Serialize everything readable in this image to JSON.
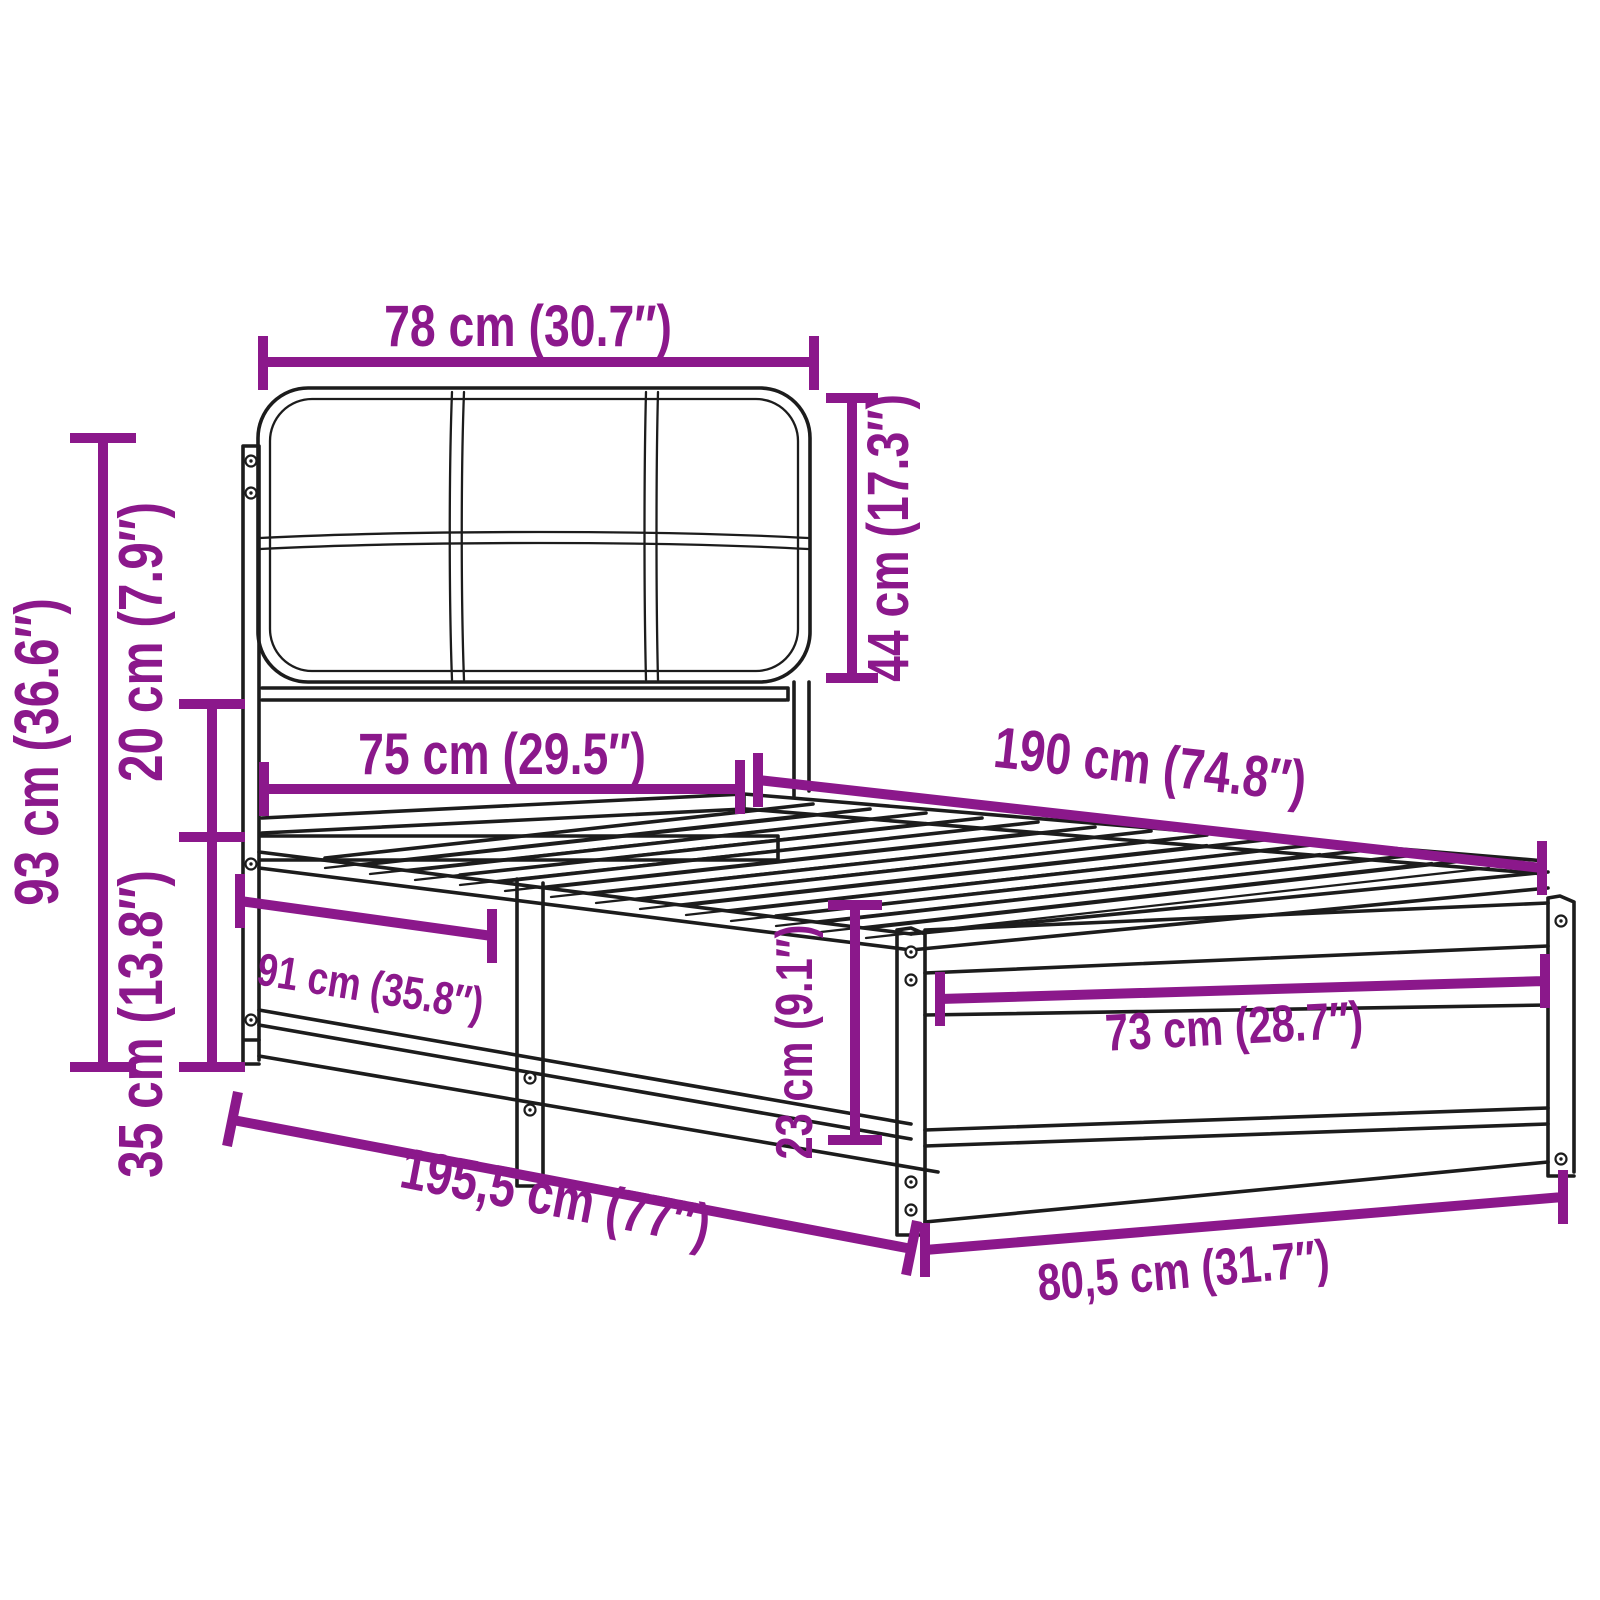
{
  "diagram": {
    "background": "#ffffff",
    "accent_color": "#8B188B",
    "line_color": "#1c1c1c",
    "dimensions": {
      "headboard_width": {
        "label": "78 cm (30.7″)"
      },
      "headboard_cushion_height": {
        "label": "44 cm (17.3″)"
      },
      "headboard_total_height": {
        "label": "93 cm (36.6″)"
      },
      "cushion_gap_height": {
        "label": "20 cm (7.9″)"
      },
      "base_height": {
        "label": "35 cm (13.8″)"
      },
      "inner_width_head": {
        "label": "75 cm (29.5″)"
      },
      "inner_length": {
        "label": "190 cm (74.8″)"
      },
      "side_rail_section": {
        "label": "91 cm (35.8″)"
      },
      "foot_rail_height": {
        "label": "23 cm (9.1″)"
      },
      "inner_width_foot": {
        "label": "73 cm (28.7″)"
      },
      "total_length": {
        "label": "195,5 cm (77″)"
      },
      "total_width": {
        "label": "80,5 cm (31.7″)"
      }
    }
  }
}
